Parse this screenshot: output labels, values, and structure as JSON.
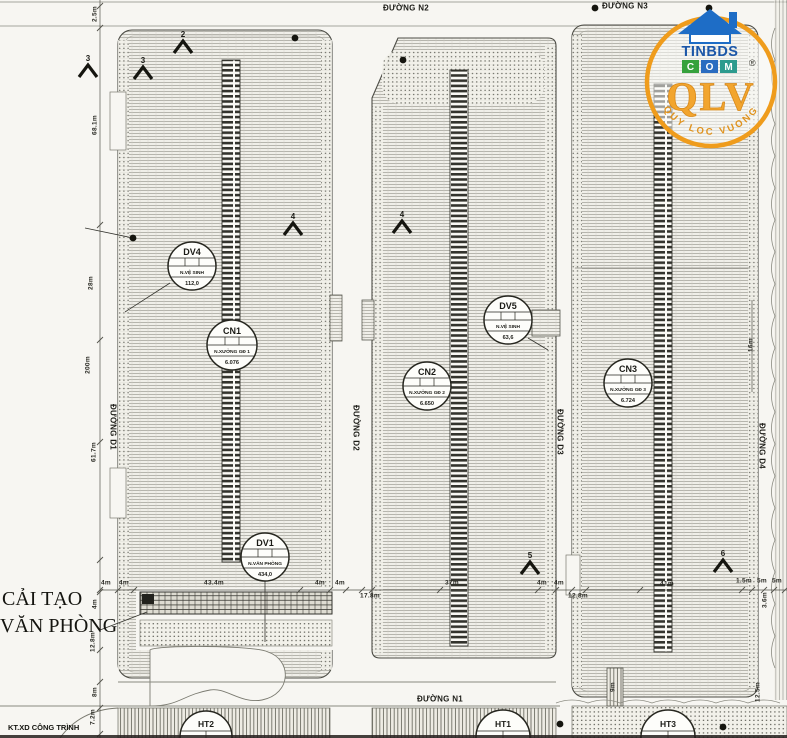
{
  "roads": {
    "n1": "ĐƯỜNG N1",
    "n2": "ĐƯỜNG N2",
    "n3": "ĐƯỜNG N3",
    "d1": "ĐƯỜNG D1",
    "d2": "ĐƯỜNG D2",
    "d3": "ĐƯỜNG D3",
    "d4": "ĐƯỜNG D4"
  },
  "callouts": {
    "dv4": {
      "id": "DV4",
      "name": "N.VỆ SINH",
      "value": "112,0"
    },
    "cn1": {
      "id": "CN1",
      "name": "N.XƯỞNG GĐ 1",
      "value": "6.076"
    },
    "dv1": {
      "id": "DV1",
      "name": "N.VĂN PHÒNG",
      "value": "434,0"
    },
    "cn2": {
      "id": "CN2",
      "name": "N.XƯỞNG GĐ 2",
      "value": "6.650"
    },
    "dv5": {
      "id": "DV5",
      "name": "N.VỆ SINH",
      "value": "63,6"
    },
    "cn3": {
      "id": "CN3",
      "name": "N.XƯỞNG GĐ 3",
      "value": "6.724"
    },
    "ht1": {
      "id": "HT1"
    },
    "ht2": {
      "id": "HT2"
    },
    "ht3": {
      "id": "HT3"
    }
  },
  "notes": {
    "renovation_line1": "CẢI TẠO",
    "renovation_line2": "VĂN PHÒNG",
    "corner": "KT.XD CÔNG TRÌNH"
  },
  "markers": {
    "m3a": "3",
    "m3b": "3",
    "m2": "2",
    "m4a": "4",
    "m4b": "4",
    "m5": "5",
    "m6": "6"
  },
  "dims": {
    "left": {
      "l1": "2.5m",
      "l2": "68.1m",
      "l3": "28m",
      "l4": "200m",
      "l5": "61.7m",
      "l6": "4m",
      "l7": "12.8m",
      "l8": "8m",
      "l9": "7.2m"
    },
    "bottom": {
      "b1": "4m",
      "b2": "4m",
      "b3": "43.4m",
      "b4": "4m",
      "b5": "4m",
      "b6": "17.8m",
      "b7": "37m",
      "b8": "4m",
      "b9": "4m",
      "b10": "12.8m",
      "b11": "41m",
      "b12": "1.5m",
      "b13": "5m",
      "b14": "5m"
    },
    "right": {
      "r1": "16m",
      "r2": "3.6m",
      "r3": "12.5m"
    },
    "misc": {
      "m1": "9m"
    }
  },
  "logo": {
    "brand_top": "TINBDS",
    "letter_c": "C",
    "letter_o": "O",
    "letter_m": "M",
    "brand_main": "QLV",
    "registered": "®",
    "tagline": "QUY LOC VUONG",
    "colors": {
      "ring": "#ef9c1c",
      "roof": "#1e6dc6",
      "box_c": "#35a13c",
      "box_o": "#2a6cc0",
      "box_m": "#2d9b8e",
      "main": "#f2a52e"
    }
  }
}
